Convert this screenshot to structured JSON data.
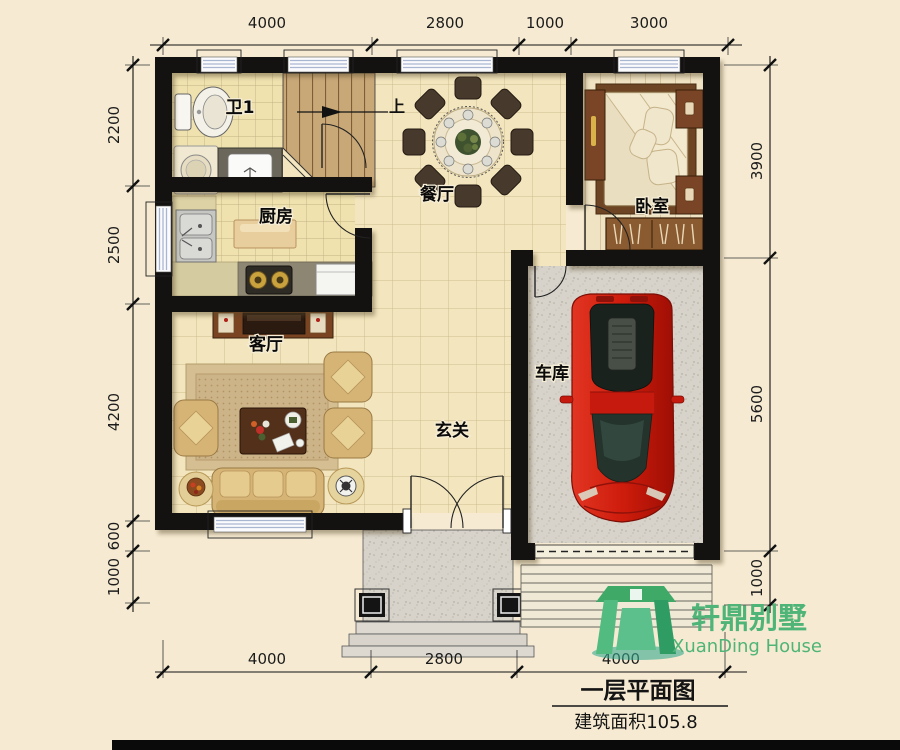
{
  "page": {
    "background": "#F6EBD2"
  },
  "rooms": {
    "bath": {
      "label": "卫1"
    },
    "kitchen": {
      "label": "厨房"
    },
    "dining": {
      "label": "餐厅"
    },
    "bedroom": {
      "label": "卧室"
    },
    "living": {
      "label": "客厅"
    },
    "foyer": {
      "label": "玄关"
    },
    "garage": {
      "label": "车库"
    }
  },
  "stairs": {
    "direction_label": "上"
  },
  "dimensions": {
    "top": [
      "4000",
      "2800",
      "1000",
      "3000"
    ],
    "bottom": [
      "4000",
      "2800",
      "4000"
    ],
    "left": [
      "2200",
      "2500",
      "4200",
      "600",
      "1000"
    ],
    "right": [
      "3900",
      "5600",
      "1000"
    ]
  },
  "title_block": {
    "plan_title": "一层平面图",
    "area_label": "建筑面积105.8"
  },
  "logo": {
    "brand_cn": "轩鼎别墅",
    "brand_en": "XuanDing House"
  },
  "colors": {
    "paper": "#F6EBD2",
    "wall": "#141210",
    "floor_tile": "#F3E6BE",
    "concrete": "#D7D3CA",
    "logo_green": "#4FB478",
    "car_red": "#C01808",
    "window_blue": "#A9B6D2"
  }
}
